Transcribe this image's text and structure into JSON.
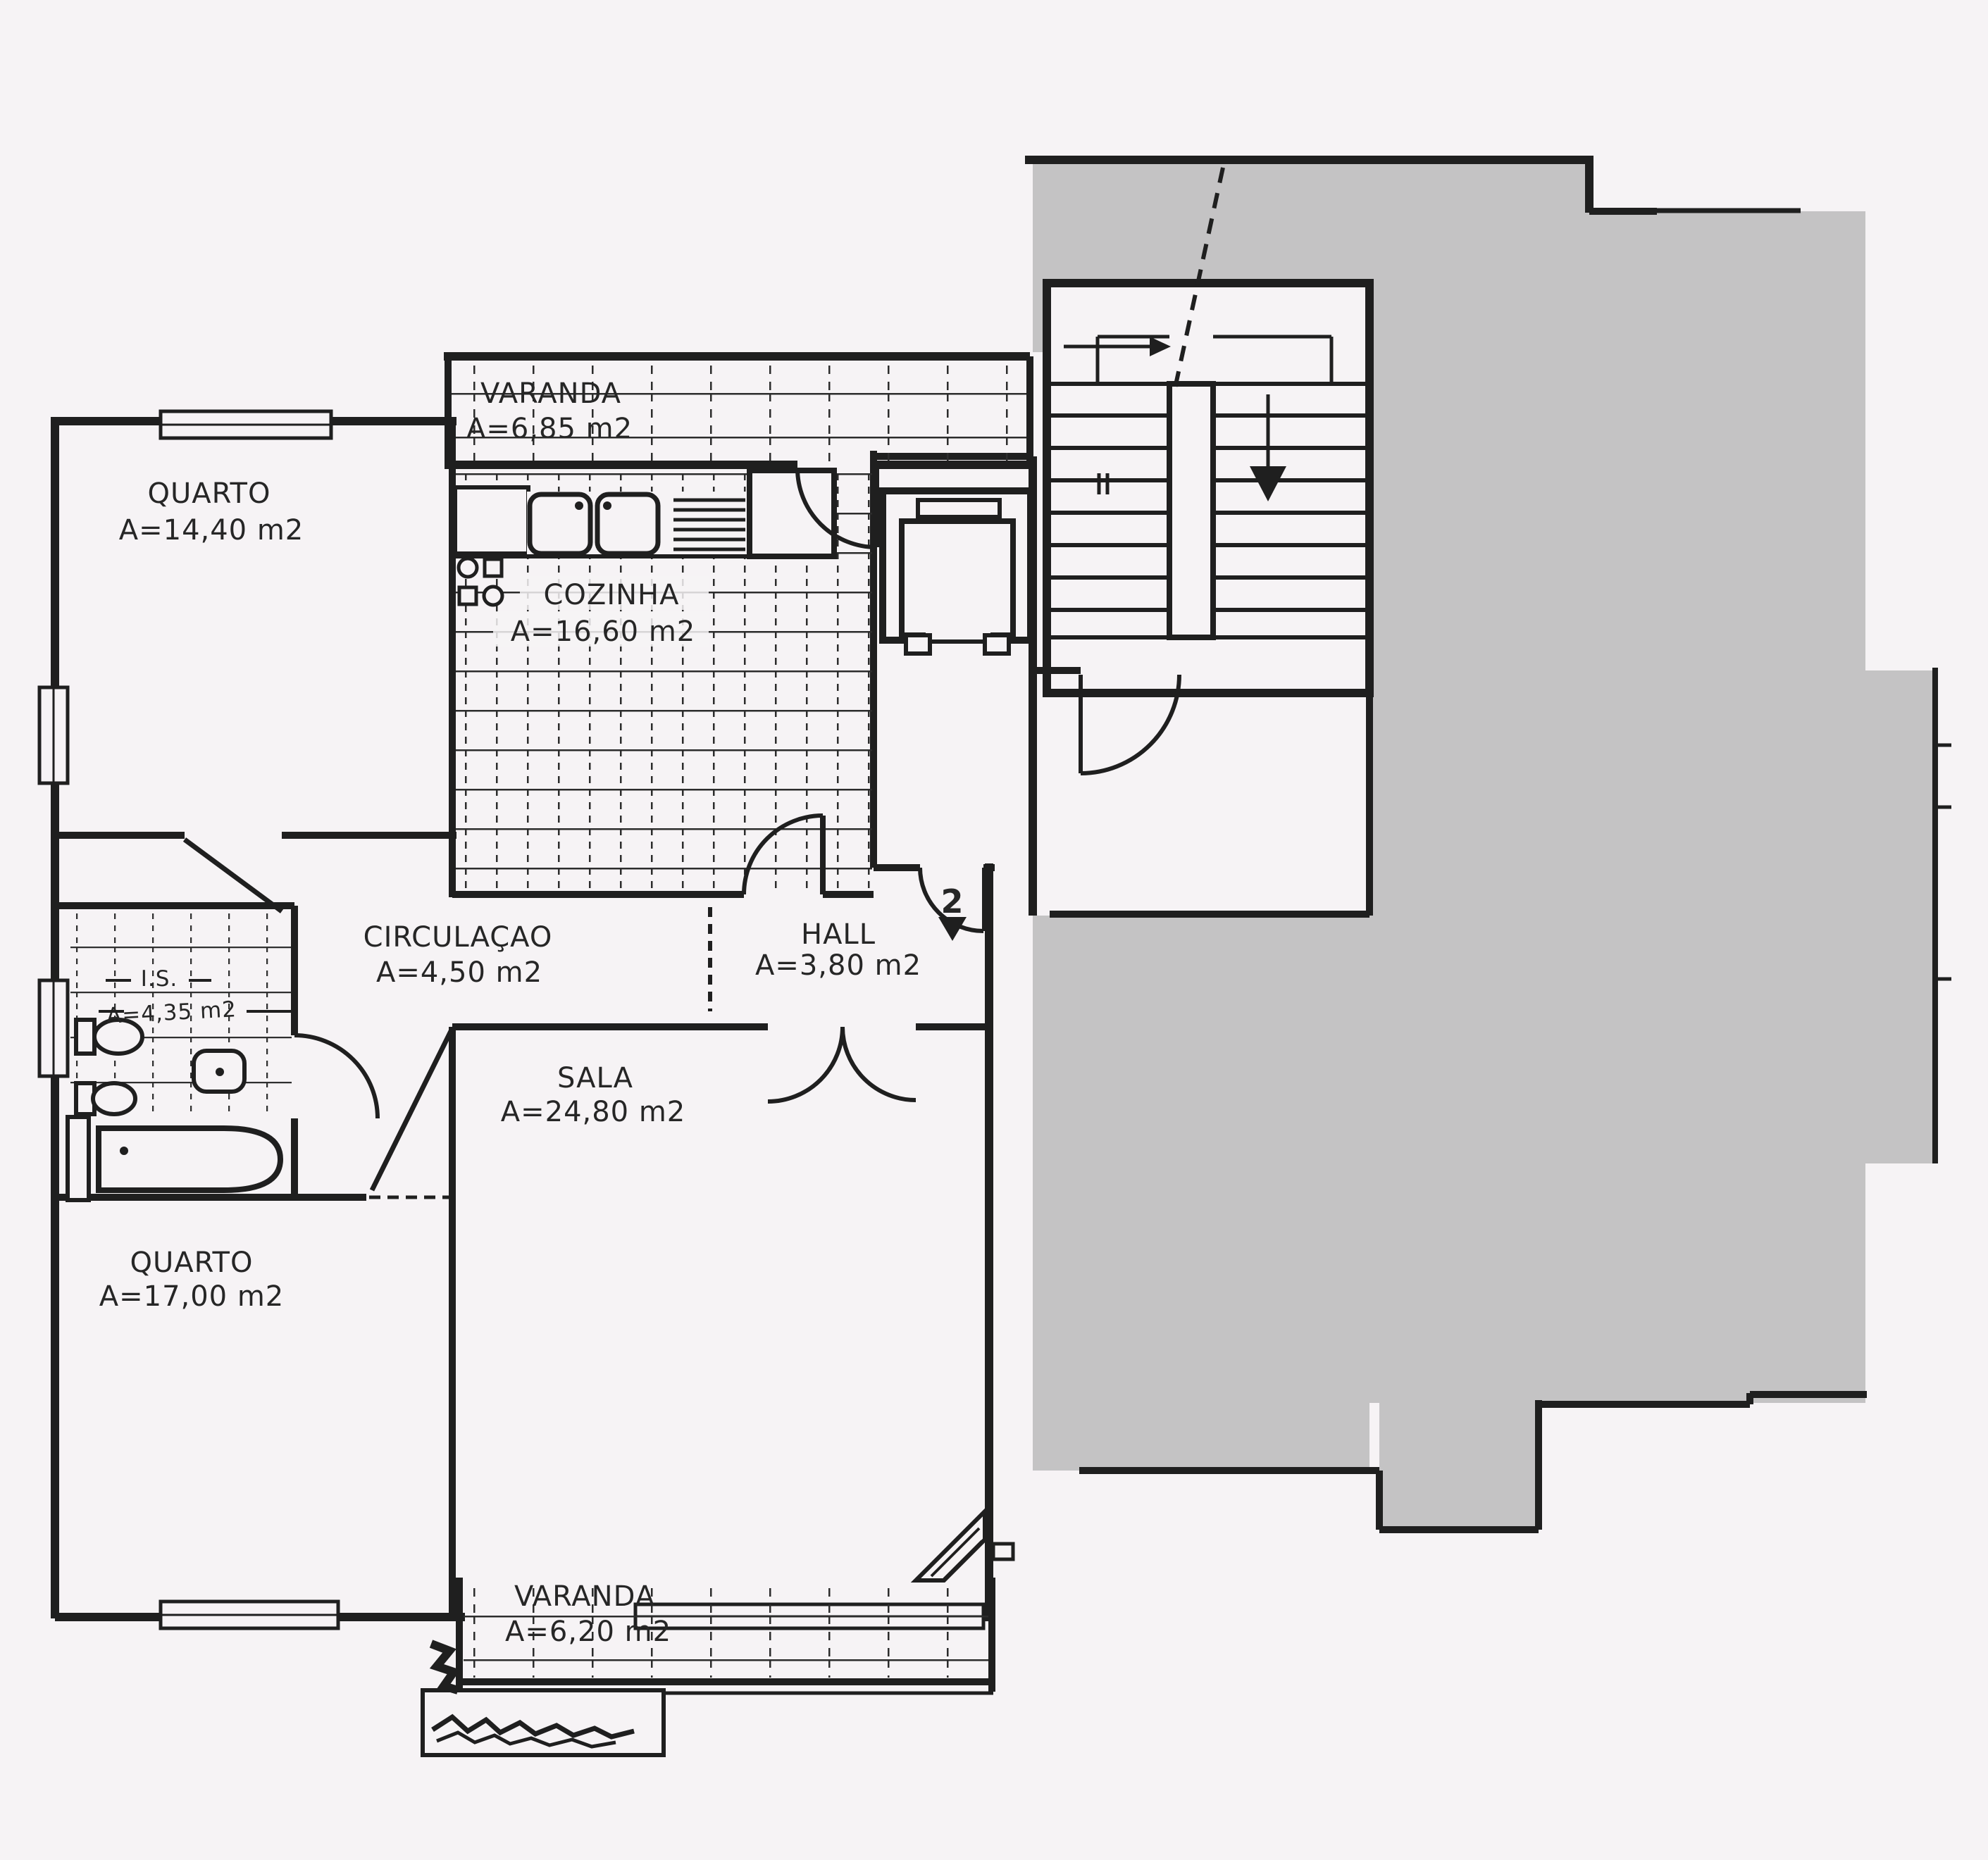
{
  "document": {
    "kind": "scanned apartment floor plan",
    "language": "Portuguese"
  },
  "colors": {
    "paper": "#f6f3f5",
    "ink": "#1f1f1f",
    "redaction_gray": "#c4c3c4"
  },
  "unit": {
    "number": "2"
  },
  "rooms": [
    {
      "id": "quarto-1",
      "name": "QUARTO",
      "area": "A=14,40  m2"
    },
    {
      "id": "varanda-top",
      "name": "VARANDA",
      "area": "A=6,85  m2"
    },
    {
      "id": "cozinha",
      "name": "COZINHA",
      "area": "A=16,60  m2"
    },
    {
      "id": "circulacao",
      "name": "CIRCULAÇAO",
      "area": "A=4,50  m2"
    },
    {
      "id": "hall",
      "name": "HALL",
      "area": "A=3,80  m2"
    },
    {
      "id": "instalacao-sanitaria",
      "name": "I.S.",
      "area": "A=4,35 m2"
    },
    {
      "id": "sala",
      "name": "SALA",
      "area": "A=24,80  m2"
    },
    {
      "id": "quarto-2",
      "name": "QUARTO",
      "area": "A=17,00  m2"
    },
    {
      "id": "varanda-bottom",
      "name": "VARANDA",
      "area": "A=6,20  m2"
    }
  ]
}
